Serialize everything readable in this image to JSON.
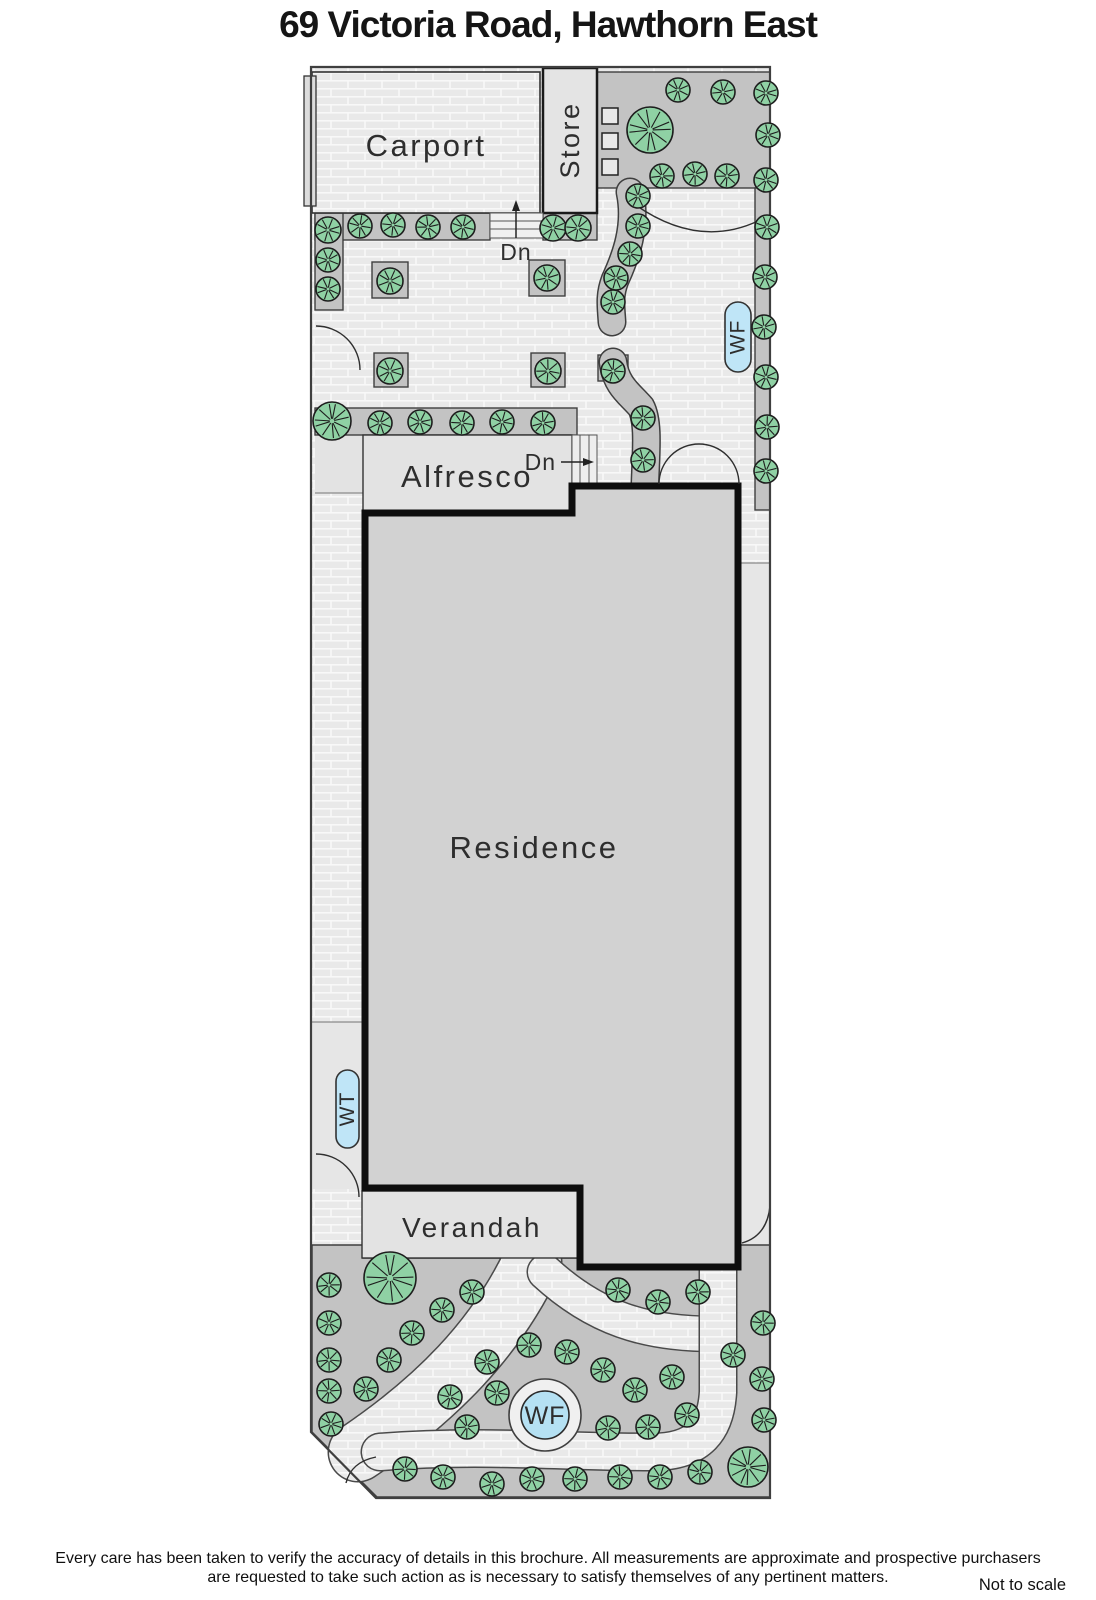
{
  "title": "69 Victoria Road, Hawthorn East",
  "footer": {
    "line1": "Every care has been taken to verify the accuracy of details in this brochure.  All measurements are approximate and prospective purchasers",
    "line2": "are requested to take such action as is necessary to satisfy themselves of any pertinent matters.",
    "scale_note": "Not to scale"
  },
  "labels": {
    "carport": "Carport",
    "store": "Store",
    "alfresco": "Alfresco",
    "residence": "Residence",
    "verandah": "Verandah",
    "dn_top": "Dn",
    "dn_alfresco": "Dn",
    "wf_pill": "WF",
    "wt_pill": "WT",
    "wf_circle": "WF"
  },
  "colors": {
    "tree_fill": "#8fd1a4",
    "tree_line": "#1d1d1d",
    "bed_fill": "#c3c3c3",
    "bed_edge": "#3f3f3f",
    "water_blue": "#b5e1f3",
    "pill_blue": "#bfe5f7",
    "residence_fill": "#d2d2d2",
    "building_fill": "#e3e3e3",
    "paving_base": "#e9e9e9",
    "plain_fill": "#e6e6e6"
  },
  "plan": {
    "trees": [
      [
        678,
        90,
        12
      ],
      [
        723,
        92,
        12
      ],
      [
        766,
        93,
        12
      ],
      [
        650,
        130,
        23
      ],
      [
        768,
        135,
        12
      ],
      [
        662,
        176,
        12
      ],
      [
        695,
        174,
        12
      ],
      [
        727,
        176,
        12
      ],
      [
        766,
        180,
        12
      ],
      [
        767,
        227,
        12
      ],
      [
        765,
        277,
        12
      ],
      [
        764,
        327,
        12
      ],
      [
        766,
        377,
        12
      ],
      [
        767,
        427,
        12
      ],
      [
        766,
        471,
        12
      ],
      [
        638,
        196,
        12
      ],
      [
        638,
        226,
        12
      ],
      [
        630,
        254,
        12
      ],
      [
        616,
        278,
        12
      ],
      [
        613,
        302,
        12
      ],
      [
        553,
        228,
        13
      ],
      [
        578,
        228,
        13
      ],
      [
        328,
        230,
        13
      ],
      [
        360,
        226,
        12
      ],
      [
        393,
        225,
        12
      ],
      [
        428,
        227,
        12
      ],
      [
        463,
        227,
        12
      ],
      [
        328,
        260,
        12
      ],
      [
        328,
        289,
        12
      ],
      [
        390,
        281,
        13
      ],
      [
        547,
        278,
        13
      ],
      [
        390,
        371,
        13
      ],
      [
        548,
        371,
        13
      ],
      [
        613,
        371,
        12
      ],
      [
        643,
        418,
        12
      ],
      [
        643,
        460,
        12
      ],
      [
        332,
        421,
        19
      ],
      [
        380,
        423,
        12
      ],
      [
        420,
        422,
        12
      ],
      [
        462,
        423,
        12
      ],
      [
        502,
        422,
        12
      ],
      [
        543,
        423,
        12
      ],
      [
        329,
        1285,
        12
      ],
      [
        329,
        1323,
        12
      ],
      [
        329,
        1360,
        12
      ],
      [
        329,
        1391,
        12
      ],
      [
        331,
        1424,
        12
      ],
      [
        366,
        1389,
        12
      ],
      [
        390,
        1278,
        26
      ],
      [
        442,
        1310,
        12
      ],
      [
        472,
        1292,
        12
      ],
      [
        412,
        1333,
        12
      ],
      [
        389,
        1360,
        12
      ],
      [
        487,
        1362,
        12
      ],
      [
        450,
        1397,
        12
      ],
      [
        467,
        1427,
        12
      ],
      [
        497,
        1393,
        12
      ],
      [
        529,
        1345,
        12
      ],
      [
        567,
        1352,
        12
      ],
      [
        603,
        1370,
        12
      ],
      [
        635,
        1390,
        12
      ],
      [
        672,
        1377,
        12
      ],
      [
        608,
        1428,
        12
      ],
      [
        648,
        1427,
        12
      ],
      [
        687,
        1415,
        12
      ],
      [
        618,
        1290,
        12
      ],
      [
        658,
        1302,
        12
      ],
      [
        698,
        1292,
        12
      ],
      [
        763,
        1323,
        12
      ],
      [
        733,
        1355,
        12
      ],
      [
        762,
        1379,
        12
      ],
      [
        764,
        1420,
        12
      ],
      [
        405,
        1469,
        12
      ],
      [
        443,
        1477,
        12
      ],
      [
        492,
        1484,
        12
      ],
      [
        532,
        1479,
        12
      ],
      [
        575,
        1479,
        12
      ],
      [
        620,
        1477,
        12
      ],
      [
        660,
        1477,
        12
      ],
      [
        700,
        1472,
        12
      ],
      [
        748,
        1467,
        20
      ]
    ],
    "planter_squares": [
      [
        602,
        108
      ],
      [
        602,
        133
      ],
      [
        602,
        159
      ]
    ],
    "beds": [
      [
        315,
        213,
        175,
        27
      ],
      [
        543,
        212,
        54,
        28
      ],
      [
        315,
        213,
        28,
        97
      ],
      [
        597,
        72,
        173,
        116
      ],
      [
        755,
        188,
        15,
        322
      ],
      [
        315,
        408,
        262,
        27
      ],
      [
        372,
        262,
        36,
        36
      ],
      [
        529,
        260,
        36,
        36
      ],
      [
        374,
        353,
        34,
        34
      ],
      [
        531,
        353,
        34,
        34
      ],
      [
        598,
        355,
        30,
        26
      ]
    ],
    "hedge_strips": [
      {
        "d": "M 630,192 C 637,226 626,256 615,280 C 609,296 611,306 612,322",
        "w": 26
      },
      {
        "d": "M 613,362 C 616,386 630,394 641,407 C 649,422 646,452 645,484",
        "w": 26
      }
    ],
    "garden_paths": [
      {
        "d": "M 532,1262 C 495,1340 435,1400 358,1452",
        "w": 58
      },
      {
        "d": "M 545,1272 C 595,1318 645,1334 714,1334",
        "w": 34
      },
      {
        "d": "M 380,1452 C 480,1444 560,1452 652,1452 C 700,1452 716,1428 718,1392 L 718,1262",
        "w": 36
      }
    ]
  }
}
